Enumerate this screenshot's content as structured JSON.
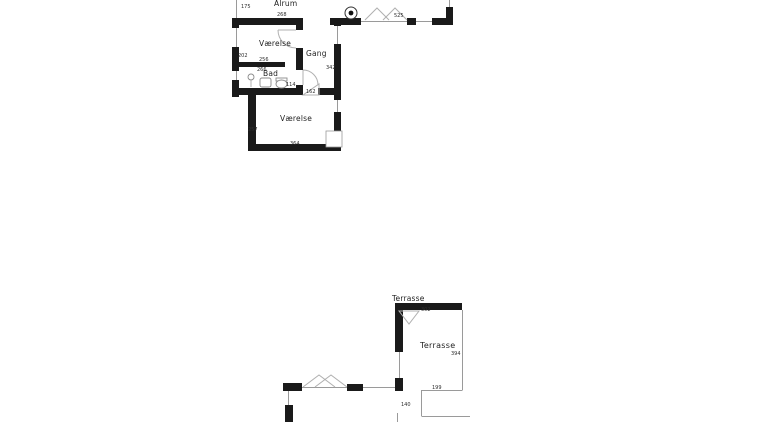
{
  "floor_plan": {
    "colors": {
      "wall": "#1a1a1a",
      "outline": "#9a9a9a",
      "text": "#1f1f1f"
    },
    "upper": {
      "rooms": {
        "alrum": "Alrum",
        "vaerelse_top": "Værelse",
        "gang": "Gang",
        "bad": "Bad",
        "vaerelse_main": "Værelse"
      },
      "dims": {
        "alrum_wall": "175",
        "alrum_window": "525",
        "vaerelse_top_width": "268",
        "vaerelse_top_height": "202",
        "vaerelse_top_bottom": "256",
        "bad_top": "266",
        "bad_door": "114",
        "gang_height": "342",
        "gang_door": "162",
        "vaerelse_main_height": "257",
        "vaerelse_main_width": "364"
      }
    },
    "lower": {
      "rooms": {
        "terrasse_title": "Terrasse",
        "terrasse": "Terrasse"
      },
      "dims": {
        "terrasse_top": "302",
        "terrasse_right": "394",
        "terrasse_bottom": "199",
        "terrasse_step": "140"
      }
    }
  }
}
